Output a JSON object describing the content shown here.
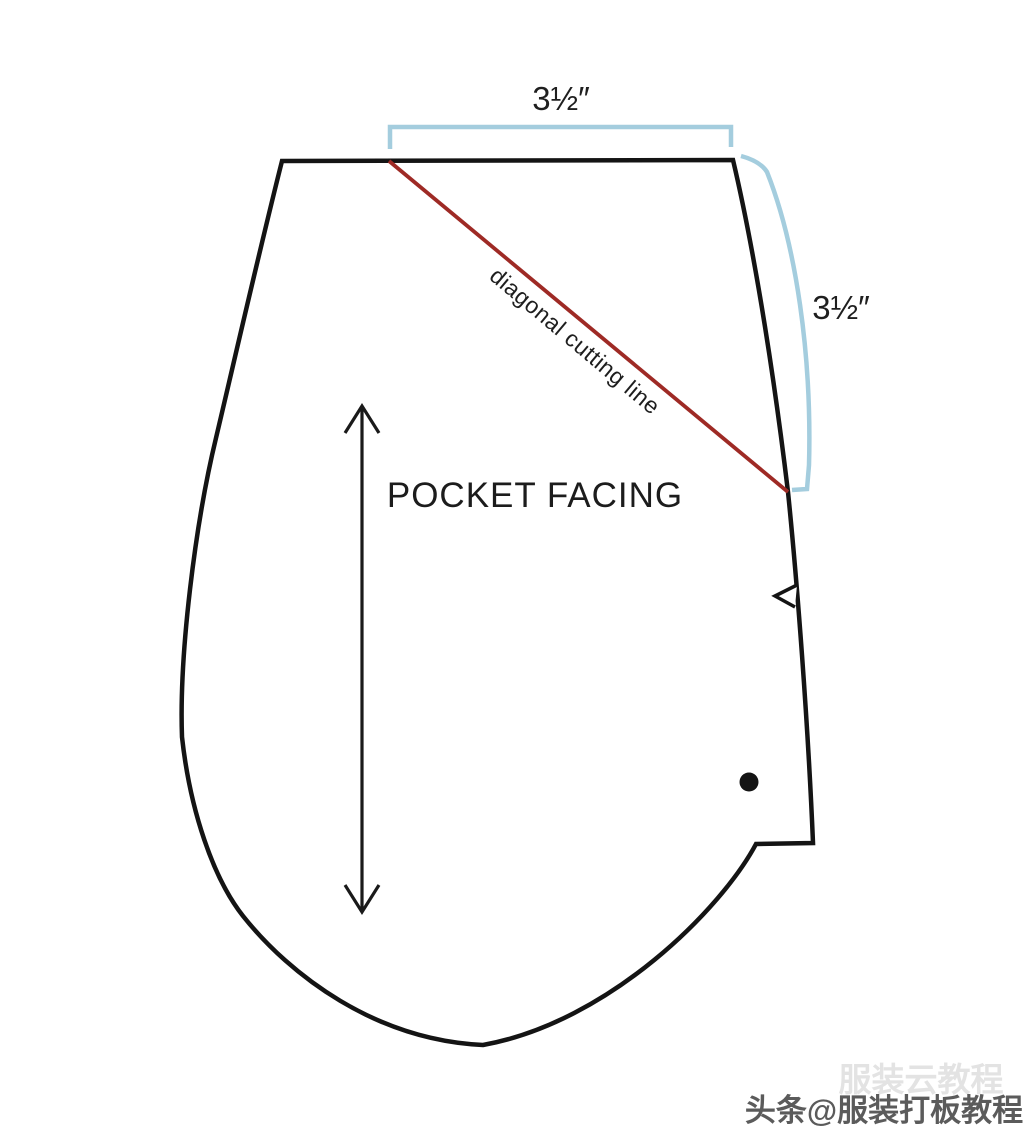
{
  "diagram": {
    "piece_name": "POCKET FACING",
    "cutting_line_label": "diagonal cutting line",
    "top_dimension": "3½″",
    "side_dimension": "3½″"
  },
  "watermark": {
    "main": "头条@服装打板教程",
    "ghost": "服装云教程"
  },
  "colors": {
    "outline": "#141414",
    "cutting_line": "#9e2a25",
    "dimension_bracket": "#a4cdde",
    "grainline": "#1a1a1a",
    "text": "#1c1c1c",
    "watermark_text": "#4e4e4e"
  }
}
